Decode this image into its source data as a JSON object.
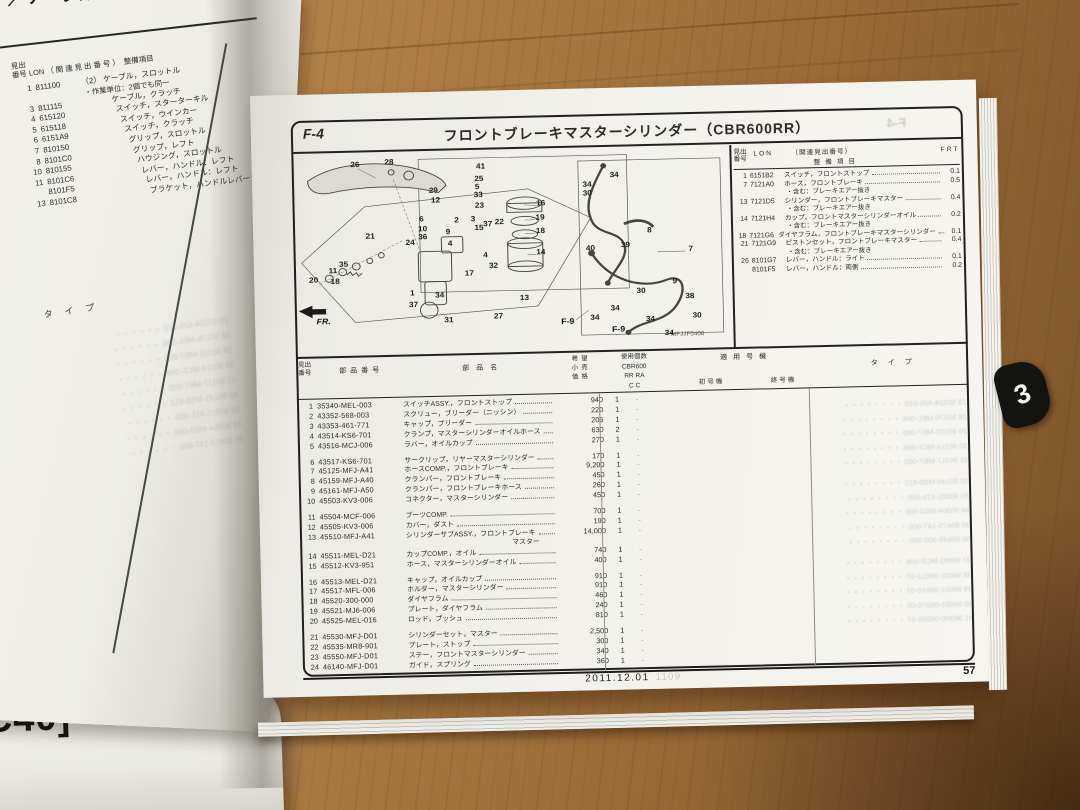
{
  "under_book_label": "C40]",
  "left_page": {
    "header_fragment": "ッチ／ケーブル",
    "table_headers": {
      "no": "見出\n番号",
      "lon": "LON",
      "rel": "（関連見出番号）",
      "item": "整備項目"
    },
    "rows": [
      {
        "no": "1",
        "lon": "811100",
        "rel": "（2）",
        "name": "ケーブル，スロットル"
      },
      {
        "note": "・作業単位：2個でも同一"
      },
      {
        "no": "3",
        "lon": "811115",
        "name": "ケーブル，クラッチ"
      },
      {
        "no": "4",
        "lon": "615120",
        "name": "スイッチ，スターターキル"
      },
      {
        "no": "5",
        "lon": "615118",
        "name": "スイッチ，ウインカー"
      },
      {
        "no": "6",
        "lon": "6151A9",
        "name": "スイッチ，クラッチ"
      },
      {
        "no": "7",
        "lon": "810150",
        "name": "グリップ，スロットル"
      },
      {
        "no": "8",
        "lon": "8101C0",
        "name": "グリップ，レフト"
      },
      {
        "no": "10",
        "lon": "810155",
        "name": "ハウジング，スロットル"
      },
      {
        "no": "11",
        "lon": "8101C6",
        "name": "レバー，ハンドル：レフト"
      },
      {
        "no": "",
        "lon": "8101F5",
        "name": "レバー，ハンドル：レフト"
      },
      {
        "no": "13",
        "lon": "8101C8",
        "name": "ブラケット，ハンドルレバー：両側"
      }
    ],
    "type_header": "タイプ"
  },
  "right_page": {
    "section": "F-4",
    "title": "フロントブレーキマスターシリンダー（CBR600RR）",
    "diagram": {
      "code": "MFJJF0400",
      "fr_label": "FR.",
      "refs": [
        {
          "t": "F-9",
          "x": 278,
          "y": 197
        },
        {
          "t": "F-9",
          "x": 330,
          "y": 207
        }
      ],
      "callouts": [
        [
          "26",
          63,
          15
        ],
        [
          "28",
          98,
          13
        ],
        [
          "41",
          192,
          20
        ],
        [
          "25",
          190,
          34
        ],
        [
          "5",
          188,
          43
        ],
        [
          "33",
          189,
          52
        ],
        [
          "23",
          190,
          64
        ],
        [
          "29",
          143,
          46
        ],
        [
          "12",
          145,
          57
        ],
        [
          "6",
          130,
          78
        ],
        [
          "2",
          166,
          80
        ],
        [
          "3",
          183,
          79
        ],
        [
          "10",
          131,
          89
        ],
        [
          "36",
          131,
          98
        ],
        [
          "9",
          157,
          93
        ],
        [
          "15",
          189,
          89
        ],
        [
          "37",
          198,
          85
        ],
        [
          "22",
          210,
          83
        ],
        [
          "16",
          253,
          63
        ],
        [
          "19",
          252,
          79
        ],
        [
          "18",
          252,
          94
        ],
        [
          "14",
          252,
          118
        ],
        [
          "21",
          77,
          96
        ],
        [
          "24",
          118,
          104
        ],
        [
          "4",
          159,
          106
        ],
        [
          "4",
          195,
          120
        ],
        [
          "35",
          49,
          127
        ],
        [
          "11",
          38,
          134
        ],
        [
          "20",
          18,
          144
        ],
        [
          "18",
          40,
          146
        ],
        [
          "17",
          178,
          140
        ],
        [
          "32",
          203,
          132
        ],
        [
          "1",
          119,
          161
        ],
        [
          "34",
          147,
          164
        ],
        [
          "37",
          120,
          174
        ],
        [
          "31",
          156,
          192
        ],
        [
          "27",
          207,
          189
        ],
        [
          "13",
          234,
          169
        ],
        [
          "34",
          329,
          33
        ],
        [
          "34",
          301,
          43
        ],
        [
          "30",
          301,
          53
        ],
        [
          "8",
          364,
          96
        ],
        [
          "39",
          339,
          112
        ],
        [
          "40",
          303,
          115
        ],
        [
          "7",
          406,
          118
        ],
        [
          "9",
          389,
          154
        ],
        [
          "30",
          354,
          164
        ],
        [
          "38",
          404,
          171
        ],
        [
          "34",
          327,
          183
        ],
        [
          "34",
          306,
          193
        ],
        [
          "30",
          411,
          193
        ],
        [
          "34",
          363,
          196
        ],
        [
          "34",
          382,
          212
        ]
      ]
    },
    "service_table": {
      "headers": {
        "no": "見出\n番号",
        "lon": "LON",
        "rel": "（関連見出番号）",
        "item": "整備項目",
        "frt": "FRT"
      },
      "rows": [
        {
          "no": "1",
          "lon": "6151B2",
          "name": "スイッチ，フロントストップ",
          "frt": "0.1"
        },
        {
          "no": "7",
          "lon": "7121A0",
          "name": "ホース，フロントブレーキ",
          "frt": "0.5",
          "sub": "・含む：ブレーキエアー抜き"
        },
        {
          "no": "13",
          "lon": "7121D5",
          "name": "シリンダー，フロントブレーキマスター",
          "frt": "0.4",
          "sub": "・含む：ブレーキエアー抜き"
        },
        {
          "no": "14",
          "lon": "7121H4",
          "name": "カップ，フロントマスターシリンダーオイル",
          "frt": "0.2",
          "sub": "・含む：ブレーキエアー抜き"
        },
        {
          "no": "18",
          "lon": "7121G6",
          "name": "ダイヤフラム，フロントブレーキマスターシリンダー",
          "frt": "0.1"
        },
        {
          "no": "21",
          "lon": "7121G9",
          "name": "ピストンセット，フロントブレーキマスター",
          "frt": "0.4",
          "sub": "・含む：ブレーキエアー抜き"
        },
        {
          "no": "26",
          "lon": "8101G7",
          "name": "レバー，ハンドル：ライト",
          "frt": "0.1"
        },
        {
          "no": "",
          "lon": "8101F5",
          "name": "レバー，ハンドル：両側",
          "frt": "0.2"
        }
      ]
    },
    "parts_table": {
      "headers": {
        "no": "見出\n番号",
        "part_no": "部品番号",
        "name": "部品名",
        "price": "希望\n小売\n価格",
        "qty": "使用個数\nCBR600\nRR  RA\nC    C",
        "applicable": "適用号機",
        "first": "初号機",
        "last": "終号機",
        "type": "タイプ"
      },
      "rows": [
        {
          "no": "1",
          "pn": "35340-MEL-003",
          "name": "スイッチASSY.，フロントストップ",
          "price": "940",
          "qty": "1",
          "qty2": "-"
        },
        {
          "no": "2",
          "pn": "43352-568-003",
          "name": "スクリュー，ブリーダー（ニッシン）",
          "price": "220",
          "qty": "1",
          "qty2": "-"
        },
        {
          "no": "3",
          "pn": "43353-461-771",
          "name": "キャップ，ブリーダー",
          "price": "205",
          "qty": "1",
          "qty2": "-"
        },
        {
          "no": "4",
          "pn": "43514-KS6-701",
          "name": "クランプ，マスターシリンダーオイルホース",
          "price": "630",
          "qty": "2",
          "qty2": "-"
        },
        {
          "no": "5",
          "pn": "43516-MCJ-006",
          "name": "ラバー，オイルカップ",
          "price": "270",
          "qty": "1",
          "qty2": "-"
        },
        {
          "no": "6",
          "pn": "43517-KS6-701",
          "name": "サークリップ，リヤーマスターシリンダー",
          "price": "170",
          "qty": "1",
          "qty2": "-",
          "gap": true
        },
        {
          "no": "7",
          "pn": "45125-MFJ-A41",
          "name": "ホースCOMP.，フロントブレーキ",
          "price": "9,200",
          "qty": "1",
          "qty2": "-"
        },
        {
          "no": "8",
          "pn": "45159-MFJ-A40",
          "name": "クランパー，フロントブレーキ",
          "price": "450",
          "qty": "1",
          "qty2": "-"
        },
        {
          "no": "9",
          "pn": "45161-MFJ-A50",
          "name": "クランパー，フロントブレーキホース",
          "price": "260",
          "qty": "1",
          "qty2": "-"
        },
        {
          "no": "10",
          "pn": "45503-KV3-006",
          "name": "コネクター，マスターシリンダー",
          "price": "450",
          "qty": "1",
          "qty2": "-"
        },
        {
          "no": "11",
          "pn": "45504-MCF-006",
          "name": "ブーツCOMP.",
          "price": "700",
          "qty": "1",
          "qty2": "-",
          "gap": true
        },
        {
          "no": "12",
          "pn": "45505-KV3-006",
          "name": "カバー，ダスト",
          "price": "190",
          "qty": "1",
          "qty2": "-"
        },
        {
          "no": "13",
          "pn": "45510-MFJ-A41",
          "name": "シリンダーサブASSY.，フロントブレーキ",
          "name2": "マスター",
          "price": "14,000",
          "qty": "1",
          "qty2": "-"
        },
        {
          "no": "14",
          "pn": "45511-MEL-D21",
          "name": "カップCOMP.，オイル",
          "price": "740",
          "qty": "1",
          "qty2": "-"
        },
        {
          "no": "15",
          "pn": "45512-KV3-951",
          "name": "ホース，マスターシリンダーオイル",
          "price": "400",
          "qty": "1",
          "qty2": "-"
        },
        {
          "no": "16",
          "pn": "45513-MEL-D21",
          "name": "キャップ，オイルカップ",
          "price": "910",
          "qty": "1",
          "qty2": "-",
          "gap": true
        },
        {
          "no": "17",
          "pn": "45517-MFL-006",
          "name": "ホルダー，マスターシリンダー",
          "price": "910",
          "qty": "1",
          "qty2": "-"
        },
        {
          "no": "18",
          "pn": "45520-300-000",
          "name": "ダイヤフラム",
          "price": "460",
          "qty": "1",
          "qty2": "-"
        },
        {
          "no": "19",
          "pn": "45521-MJ6-006",
          "name": "プレート，ダイヤフラム",
          "price": "240",
          "qty": "1",
          "qty2": "-"
        },
        {
          "no": "20",
          "pn": "45525-MEL-016",
          "name": "ロッド，プッシュ",
          "price": "810",
          "qty": "1",
          "qty2": "-"
        },
        {
          "no": "21",
          "pn": "45530-MFJ-D01",
          "name": "シリンダーセット，マスター",
          "price": "2,500",
          "qty": "1",
          "qty2": "-",
          "gap": true
        },
        {
          "no": "22",
          "pn": "45535-MR8-901",
          "name": "プレート，ストップ",
          "price": "300",
          "qty": "1",
          "qty2": "-"
        },
        {
          "no": "23",
          "pn": "45550-MFJ-D01",
          "name": "ステー，フロントマスターシリンダー",
          "price": "340",
          "qty": "1",
          "qty2": "-"
        },
        {
          "no": "24",
          "pn": "46140-MFJ-D01",
          "name": "ガイド，スプリング",
          "price": "360",
          "qty": "1",
          "qty2": "-"
        }
      ]
    },
    "footer": {
      "date": "2011.12.01",
      "ghost": "1109"
    },
    "page_number": "57",
    "tab_number": "3"
  },
  "ghost_lines": [
    "25 50324-425-010",
    "28 50170-MEL-006",
    "29 90101-MB7-000",
    "30 90114-MCF-006",
    "31 90117-MB7-000",
    "32 90145-MS9-612",
    "33 90301-415-000",
    "34 90304-MS3-000",
    "35 90473-147-000",
    "36 90645-300-000",
    "37 90651-MCF-006",
    "38 96001-06012-07",
    "39 96001-06016-07",
    "40 96001-06070-05",
    "41 96300-06028-07"
  ]
}
